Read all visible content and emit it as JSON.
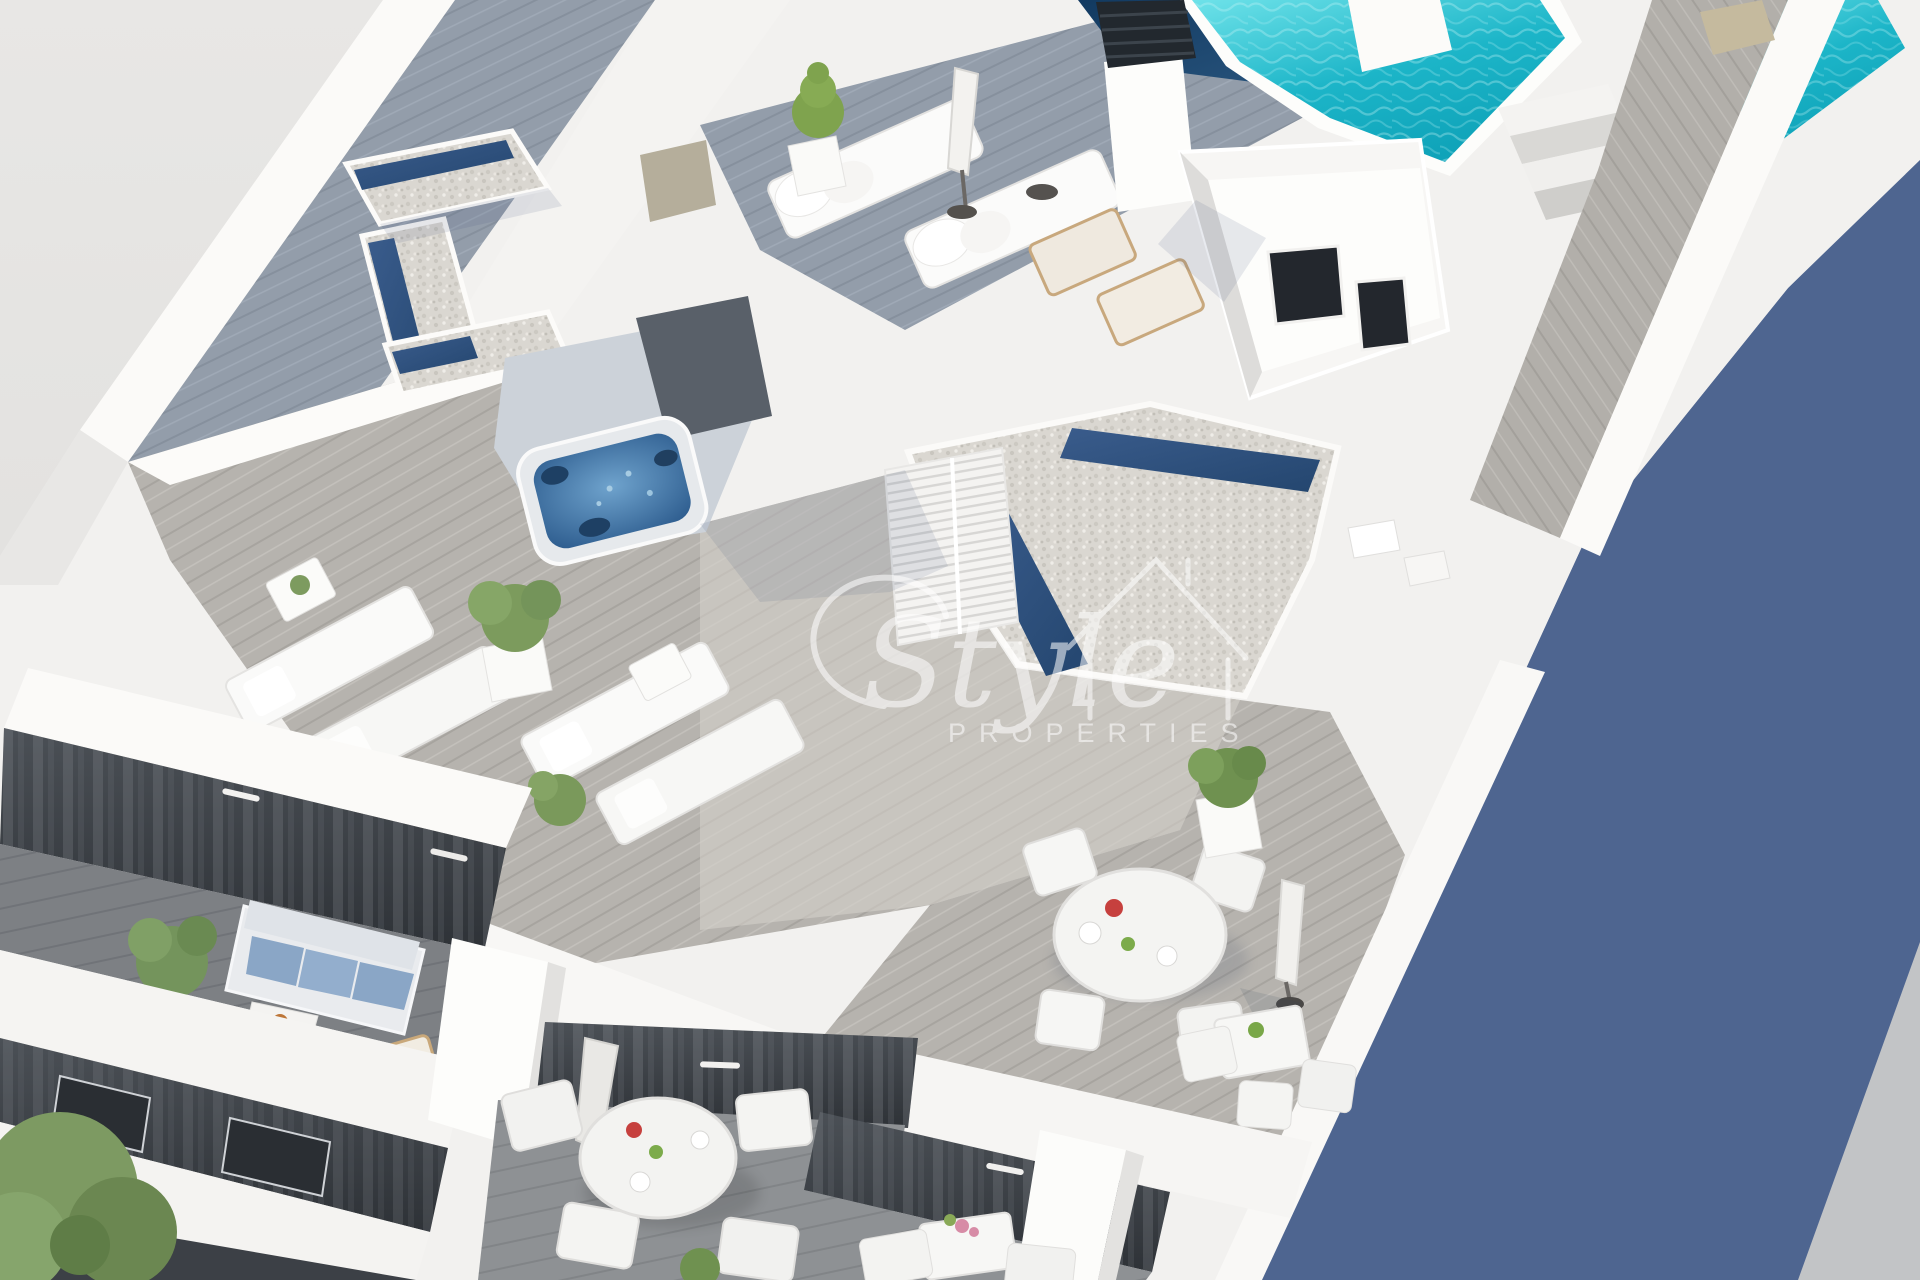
{
  "image": {
    "kind": "3d-architectural-render",
    "subject": "Aerial isometric view of a white modern apartment building rooftop: penthouse solarium terraces with swimming pool, jacuzzi, sun loungers, dining sets, potted plants and lower balconies with dark glass facades",
    "style": "minimalist new-build promotional render, strong sunlight from upper left, long blue shadow cast to the right"
  },
  "watermark": {
    "brand_script": "Style",
    "brand_sub": "PROPERTIES",
    "icon": "house-outline-icon",
    "color": "#ffffff"
  },
  "palette": {
    "background": "#e6e5e3",
    "shadow_blue": "#4e6590",
    "building_white": "#f2f1ef",
    "deck_gray": "#b6b3ae",
    "deck_blue_gray": "#939daa",
    "pool_turquoise": "#1cb5c8",
    "skylight_navy": "#2e5080",
    "jacuzzi_blue": "#3f77ad",
    "gravel_roof": "#dad7d1",
    "facade_dark": "#3a3f45",
    "plant_green": "#7c9b5d",
    "wood_tan": "#c9a87a",
    "accent_red": "#c6403e"
  },
  "scene": {
    "rooftop_elements": [
      "swimming-pool",
      "pool-steps",
      "chimney-vent",
      "navy-skylight-strips",
      "gravel-roof-volumes",
      "jacuzzi",
      "louvered-stair-box",
      "lightwell-courtyard",
      "walkway-deck"
    ],
    "furniture": [
      "cushioned-sun-loungers",
      "flat-sun-loungers",
      "wooden-deck-chairs",
      "round-dining-table-4-chairs",
      "square-bistro-tables",
      "closed-parasols",
      "potted-plants",
      "conical-cypress-pot"
    ],
    "lower_floors": [
      "dark-glass-facade-with-curtains",
      "balcony-sofa-blue-cushions",
      "balcony-round-dining-table",
      "balcony-bistro-table-with-flowers",
      "white-floor-slabs",
      "street-tree"
    ]
  }
}
